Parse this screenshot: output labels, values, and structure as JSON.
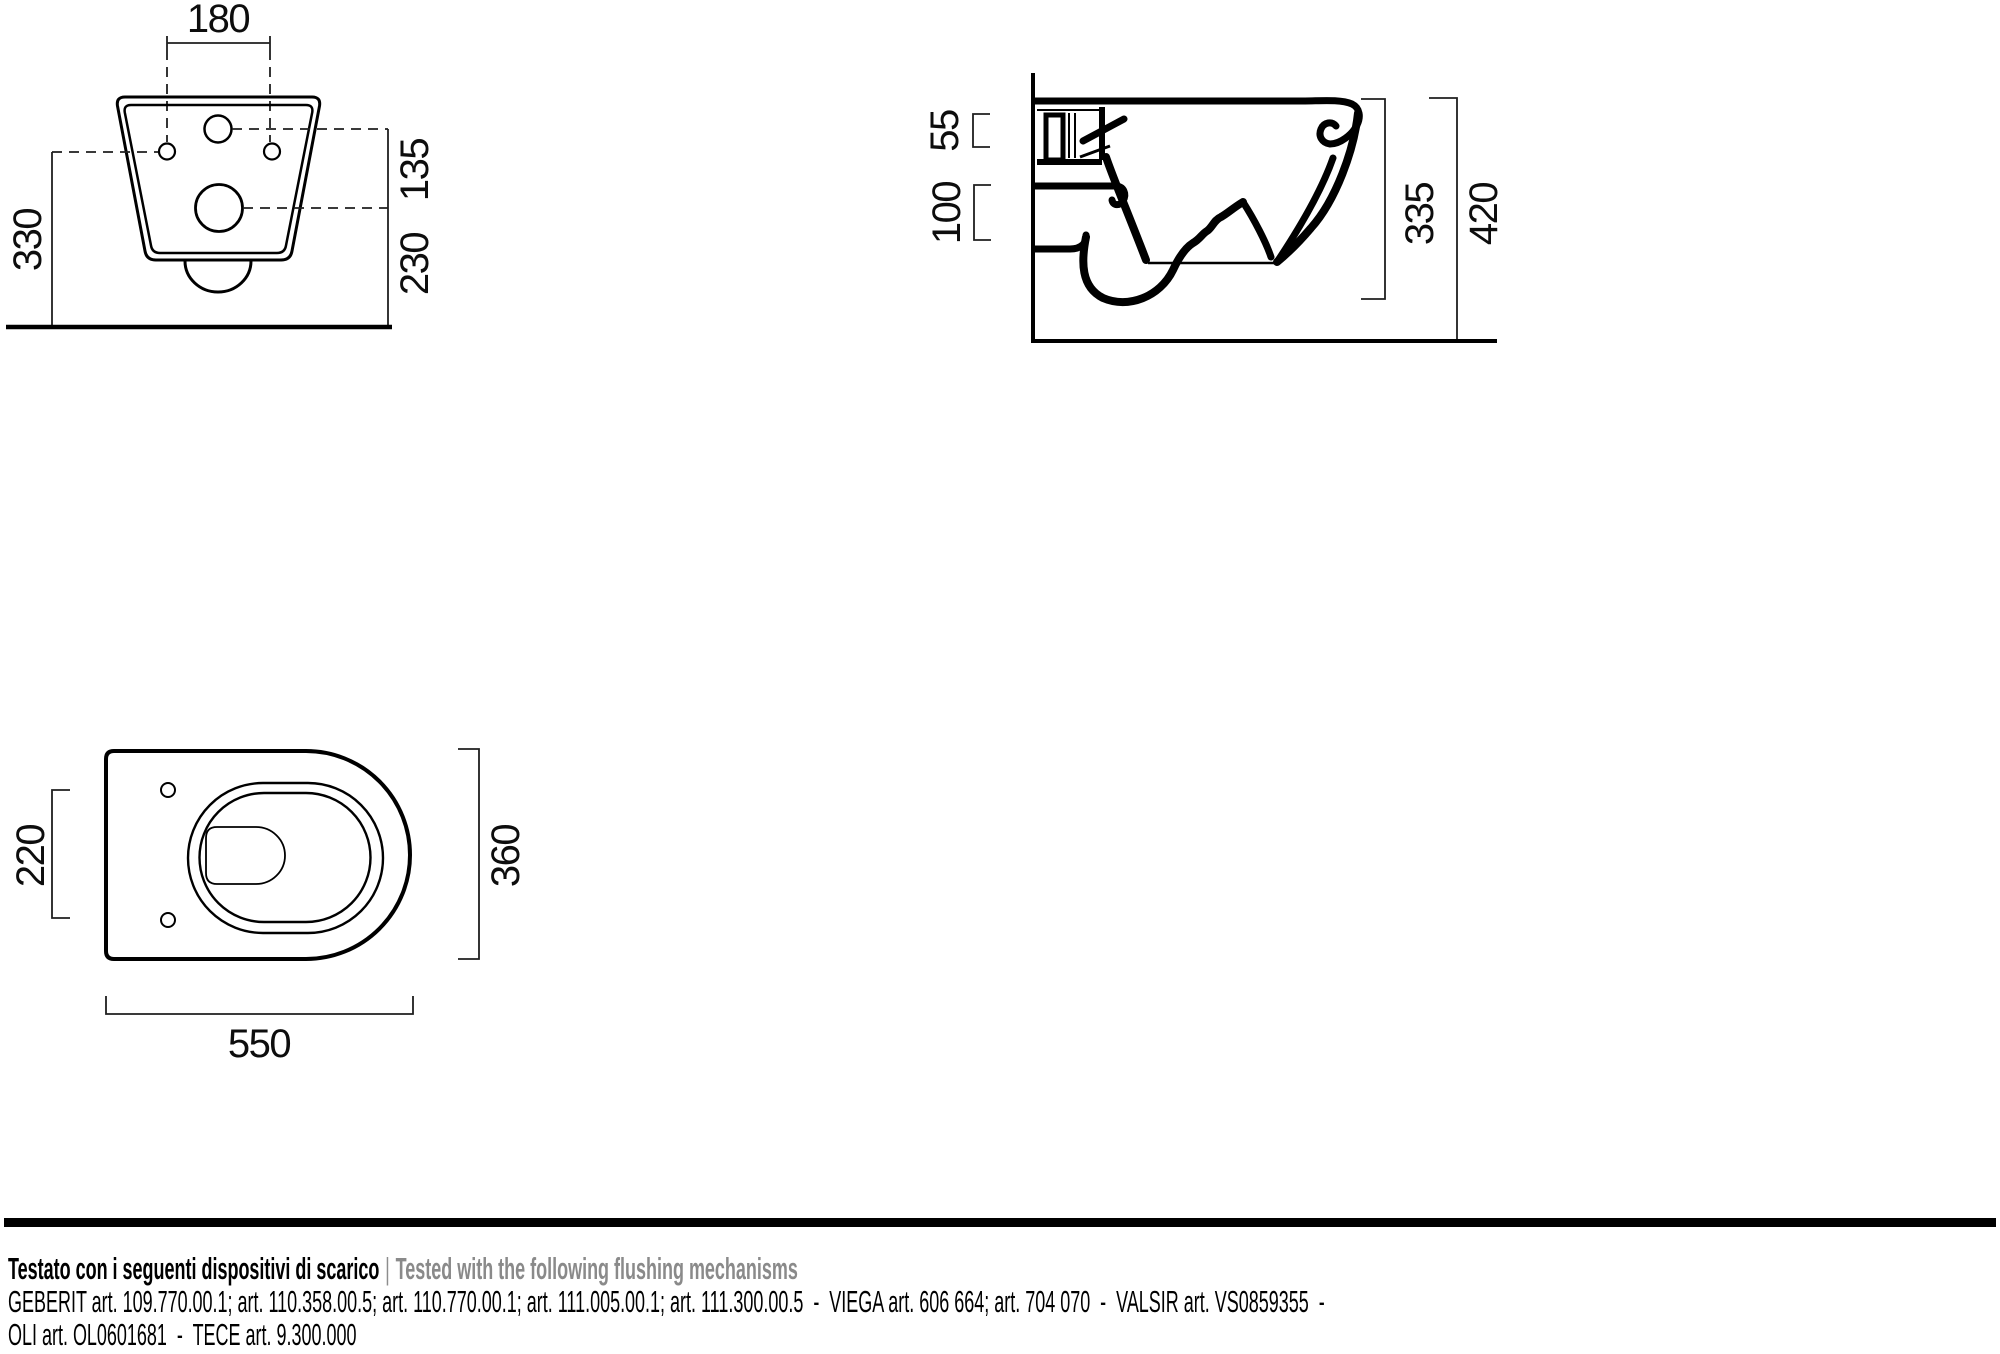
{
  "colors": {
    "ink": "#000000",
    "gray_text": "#8a8a8a"
  },
  "views": {
    "front": {
      "dim_width_between_holes": "180",
      "dim_floor_to_holes": "330",
      "dim_inlet_to_outlet": "135",
      "dim_outlet_to_floor": "230"
    },
    "side": {
      "dim_inlet": "55",
      "dim_outlet": "100",
      "dim_bowl_height": "335",
      "dim_total_height": "420"
    },
    "plan": {
      "dim_hole_spacing": "220",
      "dim_width": "360",
      "dim_length": "550"
    }
  },
  "footer": {
    "tested_it": "Testato con i seguenti dispositivi di scarico",
    "separator": "|",
    "tested_en": "Tested with the following flushing mechanisms",
    "mechanisms_line1": "GEBERIT art. 109.770.00.1; art. 110.358.00.5; art. 110.770.00.1; art. 111.005.00.1; art. 111.300.00.5  -  VIEGA art. 606 664; art. 704 070  -  VALSIR art. VS0859355  -",
    "mechanisms_line2": "OLI art. OL0601681  -  TECE art. 9.300.000"
  }
}
